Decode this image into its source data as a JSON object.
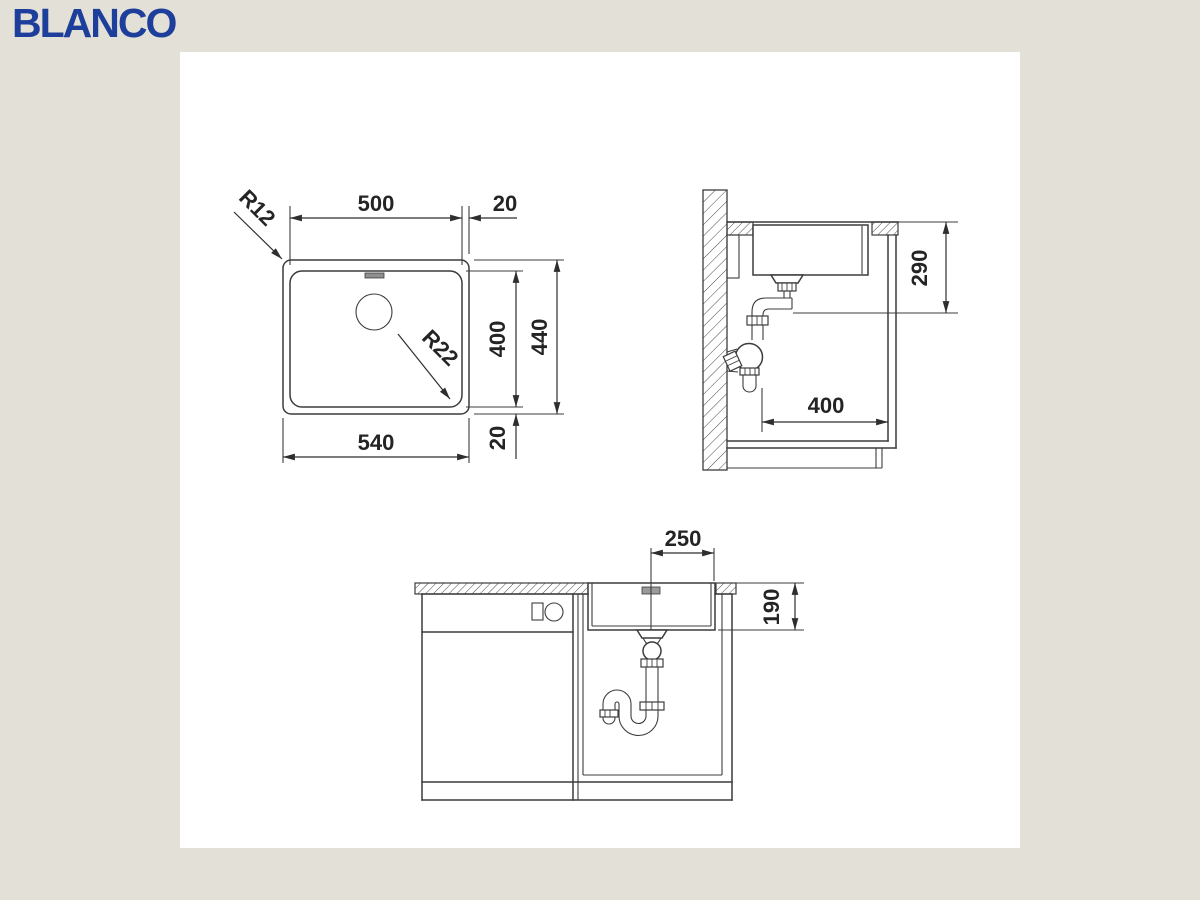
{
  "logo": {
    "text": "BLANCO"
  },
  "colors": {
    "logo_blue": "#1d3e9b",
    "background": "#e3e0d8",
    "paper": "#ffffff",
    "line": "#3c3c3c"
  },
  "plan_view": {
    "dim_bowl_width": "500",
    "dim_rim_right": "20",
    "dim_outer_width": "540",
    "dim_bowl_depth": "400",
    "dim_outer_depth": "440",
    "dim_rim_bottom": "20",
    "radius_outer_corner": "R12",
    "radius_bowl_corner": "R22"
  },
  "side_view": {
    "dim_bowl_height": "290",
    "dim_drain_distance": "400"
  },
  "front_view": {
    "dim_drain_center": "250",
    "dim_bowl_height": "190"
  }
}
